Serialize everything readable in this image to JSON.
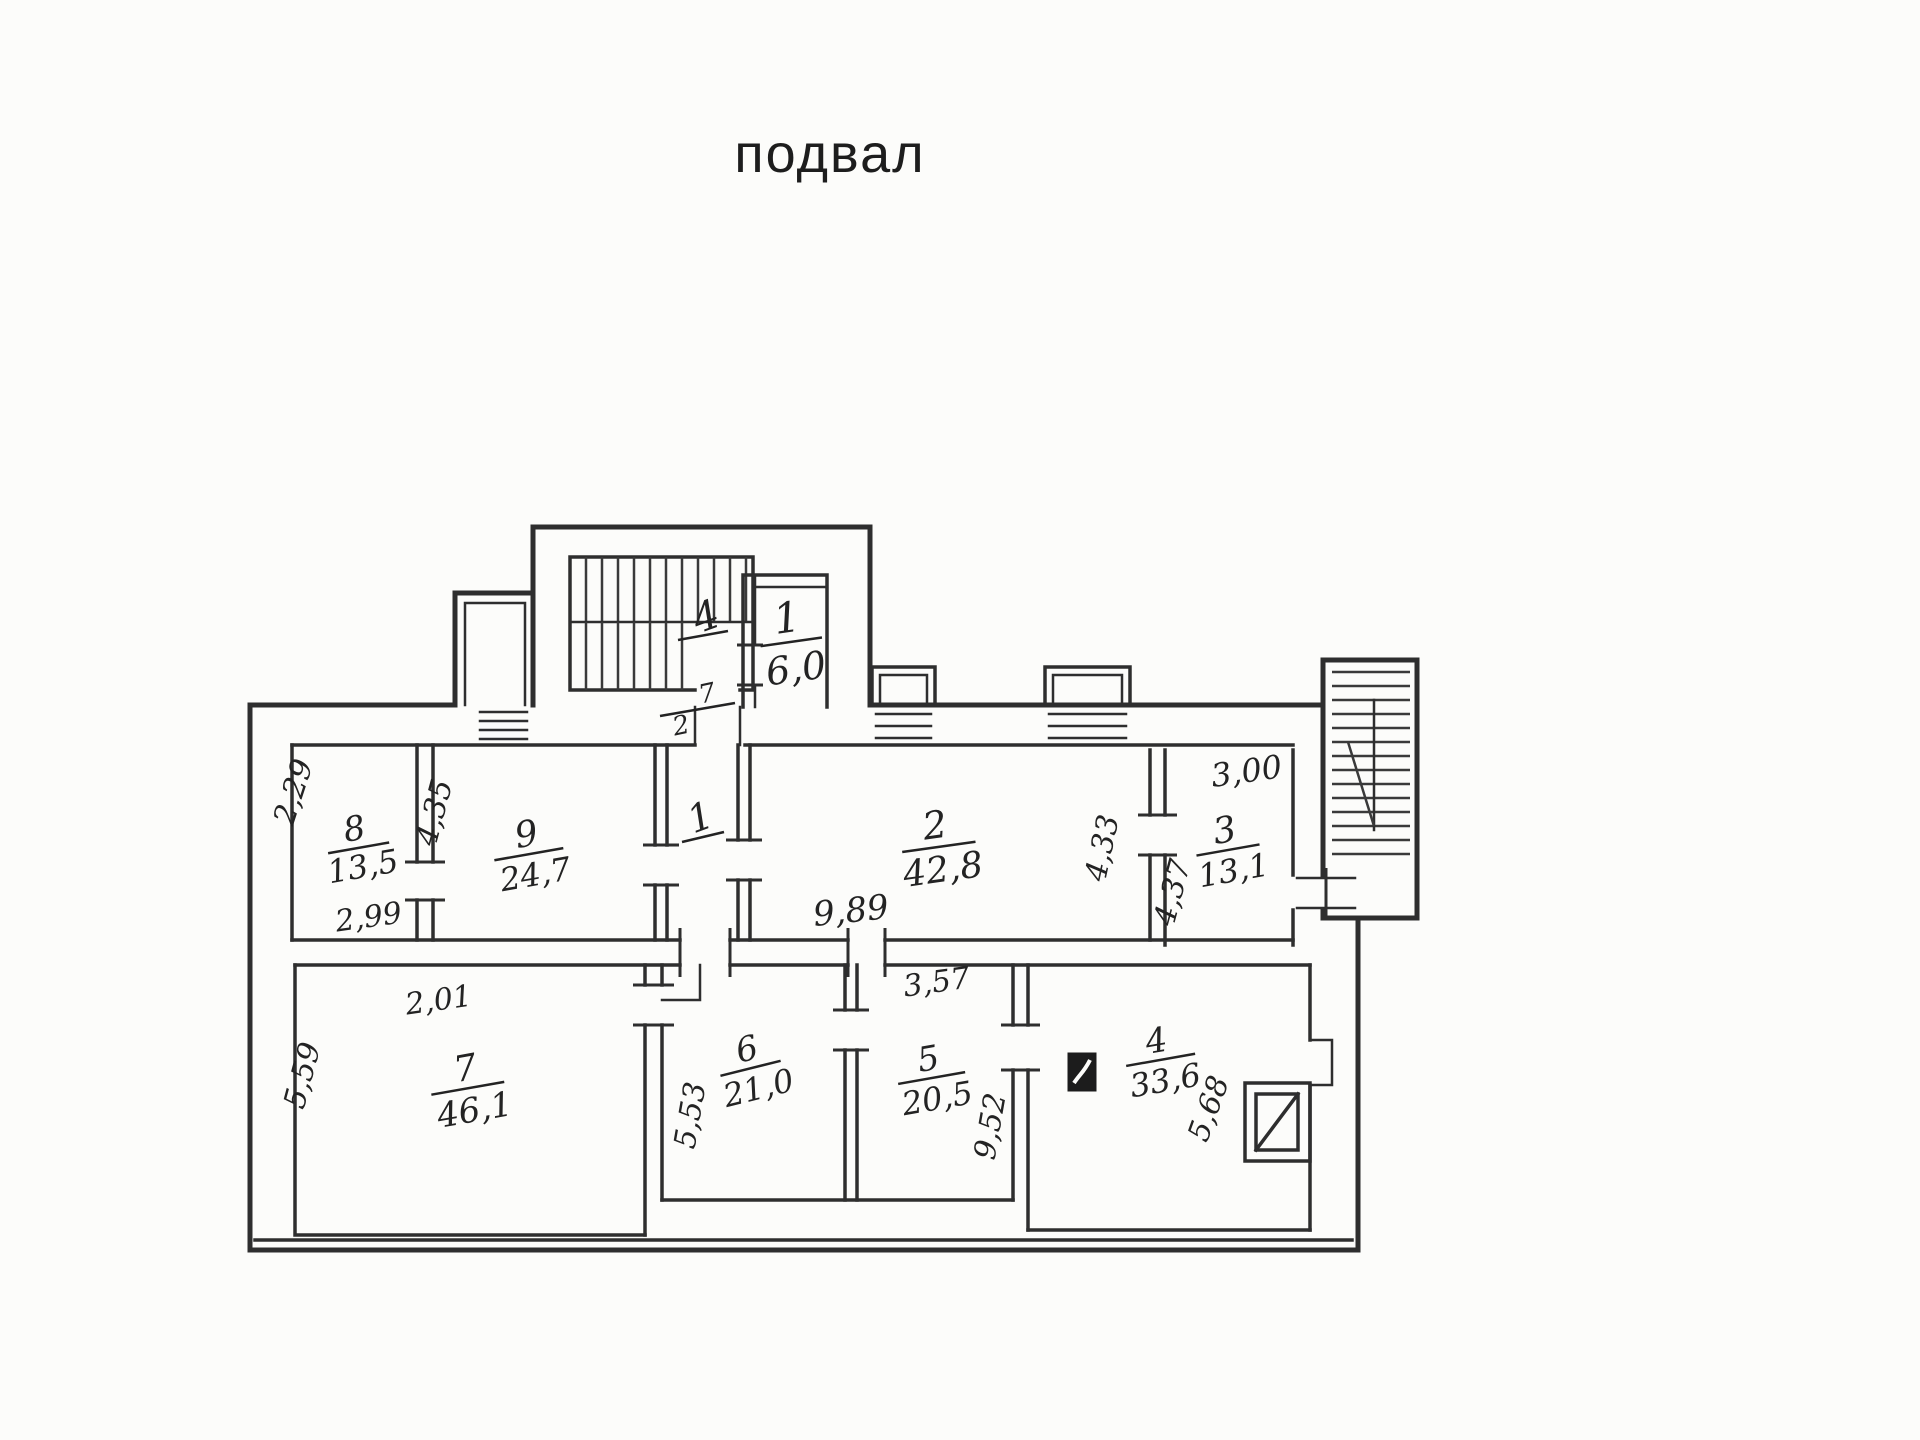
{
  "document": {
    "title": "подвал"
  },
  "plan": {
    "colors": {
      "ink": "#2e2e2e",
      "paper": "#fcfcfa"
    },
    "stairwell": {
      "flight_label": "4",
      "mark_a": "7",
      "mark_b": "2"
    },
    "rooms": {
      "tambour": {
        "number": "1",
        "area": "6,0"
      },
      "corridor": {
        "number": "1"
      },
      "r2": {
        "number": "2",
        "area": "42,8"
      },
      "r3": {
        "number": "3",
        "area": "13,1"
      },
      "r4": {
        "number": "4",
        "area": "33,6"
      },
      "r5": {
        "number": "5",
        "area": "20,5"
      },
      "r6": {
        "number": "6",
        "area": "21,0"
      },
      "r7": {
        "number": "7",
        "area": "46,1"
      },
      "r8": {
        "number": "8",
        "area": "13,5"
      },
      "r9": {
        "number": "9",
        "area": "24,7"
      }
    },
    "dimensions": {
      "room8_left": "2,29",
      "room8_right": "4,35",
      "room8_bottom": "2,99",
      "room2_bottom": "9,89",
      "room2_right": "4,33",
      "room3_left": "4,37",
      "room3_top": "3,00",
      "room7_top": "2,01",
      "room7_left": "5,59",
      "room6_left": "5,53",
      "room5_top": "3,57",
      "room5_right": "9,52",
      "room4_right": "5,68"
    }
  }
}
